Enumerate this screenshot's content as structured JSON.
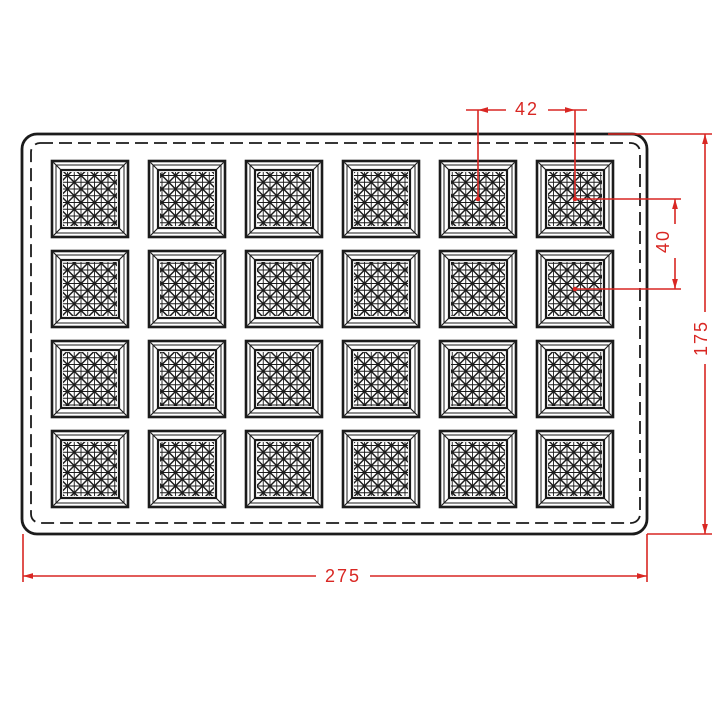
{
  "drawing": {
    "tray": {
      "columns": 6,
      "rows": 4,
      "cavities": 24
    },
    "dimensions": {
      "pitch_x": {
        "label": "42"
      },
      "pitch_y": {
        "label": "40"
      },
      "overall_height": {
        "label": "175"
      },
      "overall_width": {
        "label": "275"
      }
    },
    "colors": {
      "line": "#1b1b1b",
      "dimension": "#d92723",
      "background": "#ffffff"
    }
  }
}
